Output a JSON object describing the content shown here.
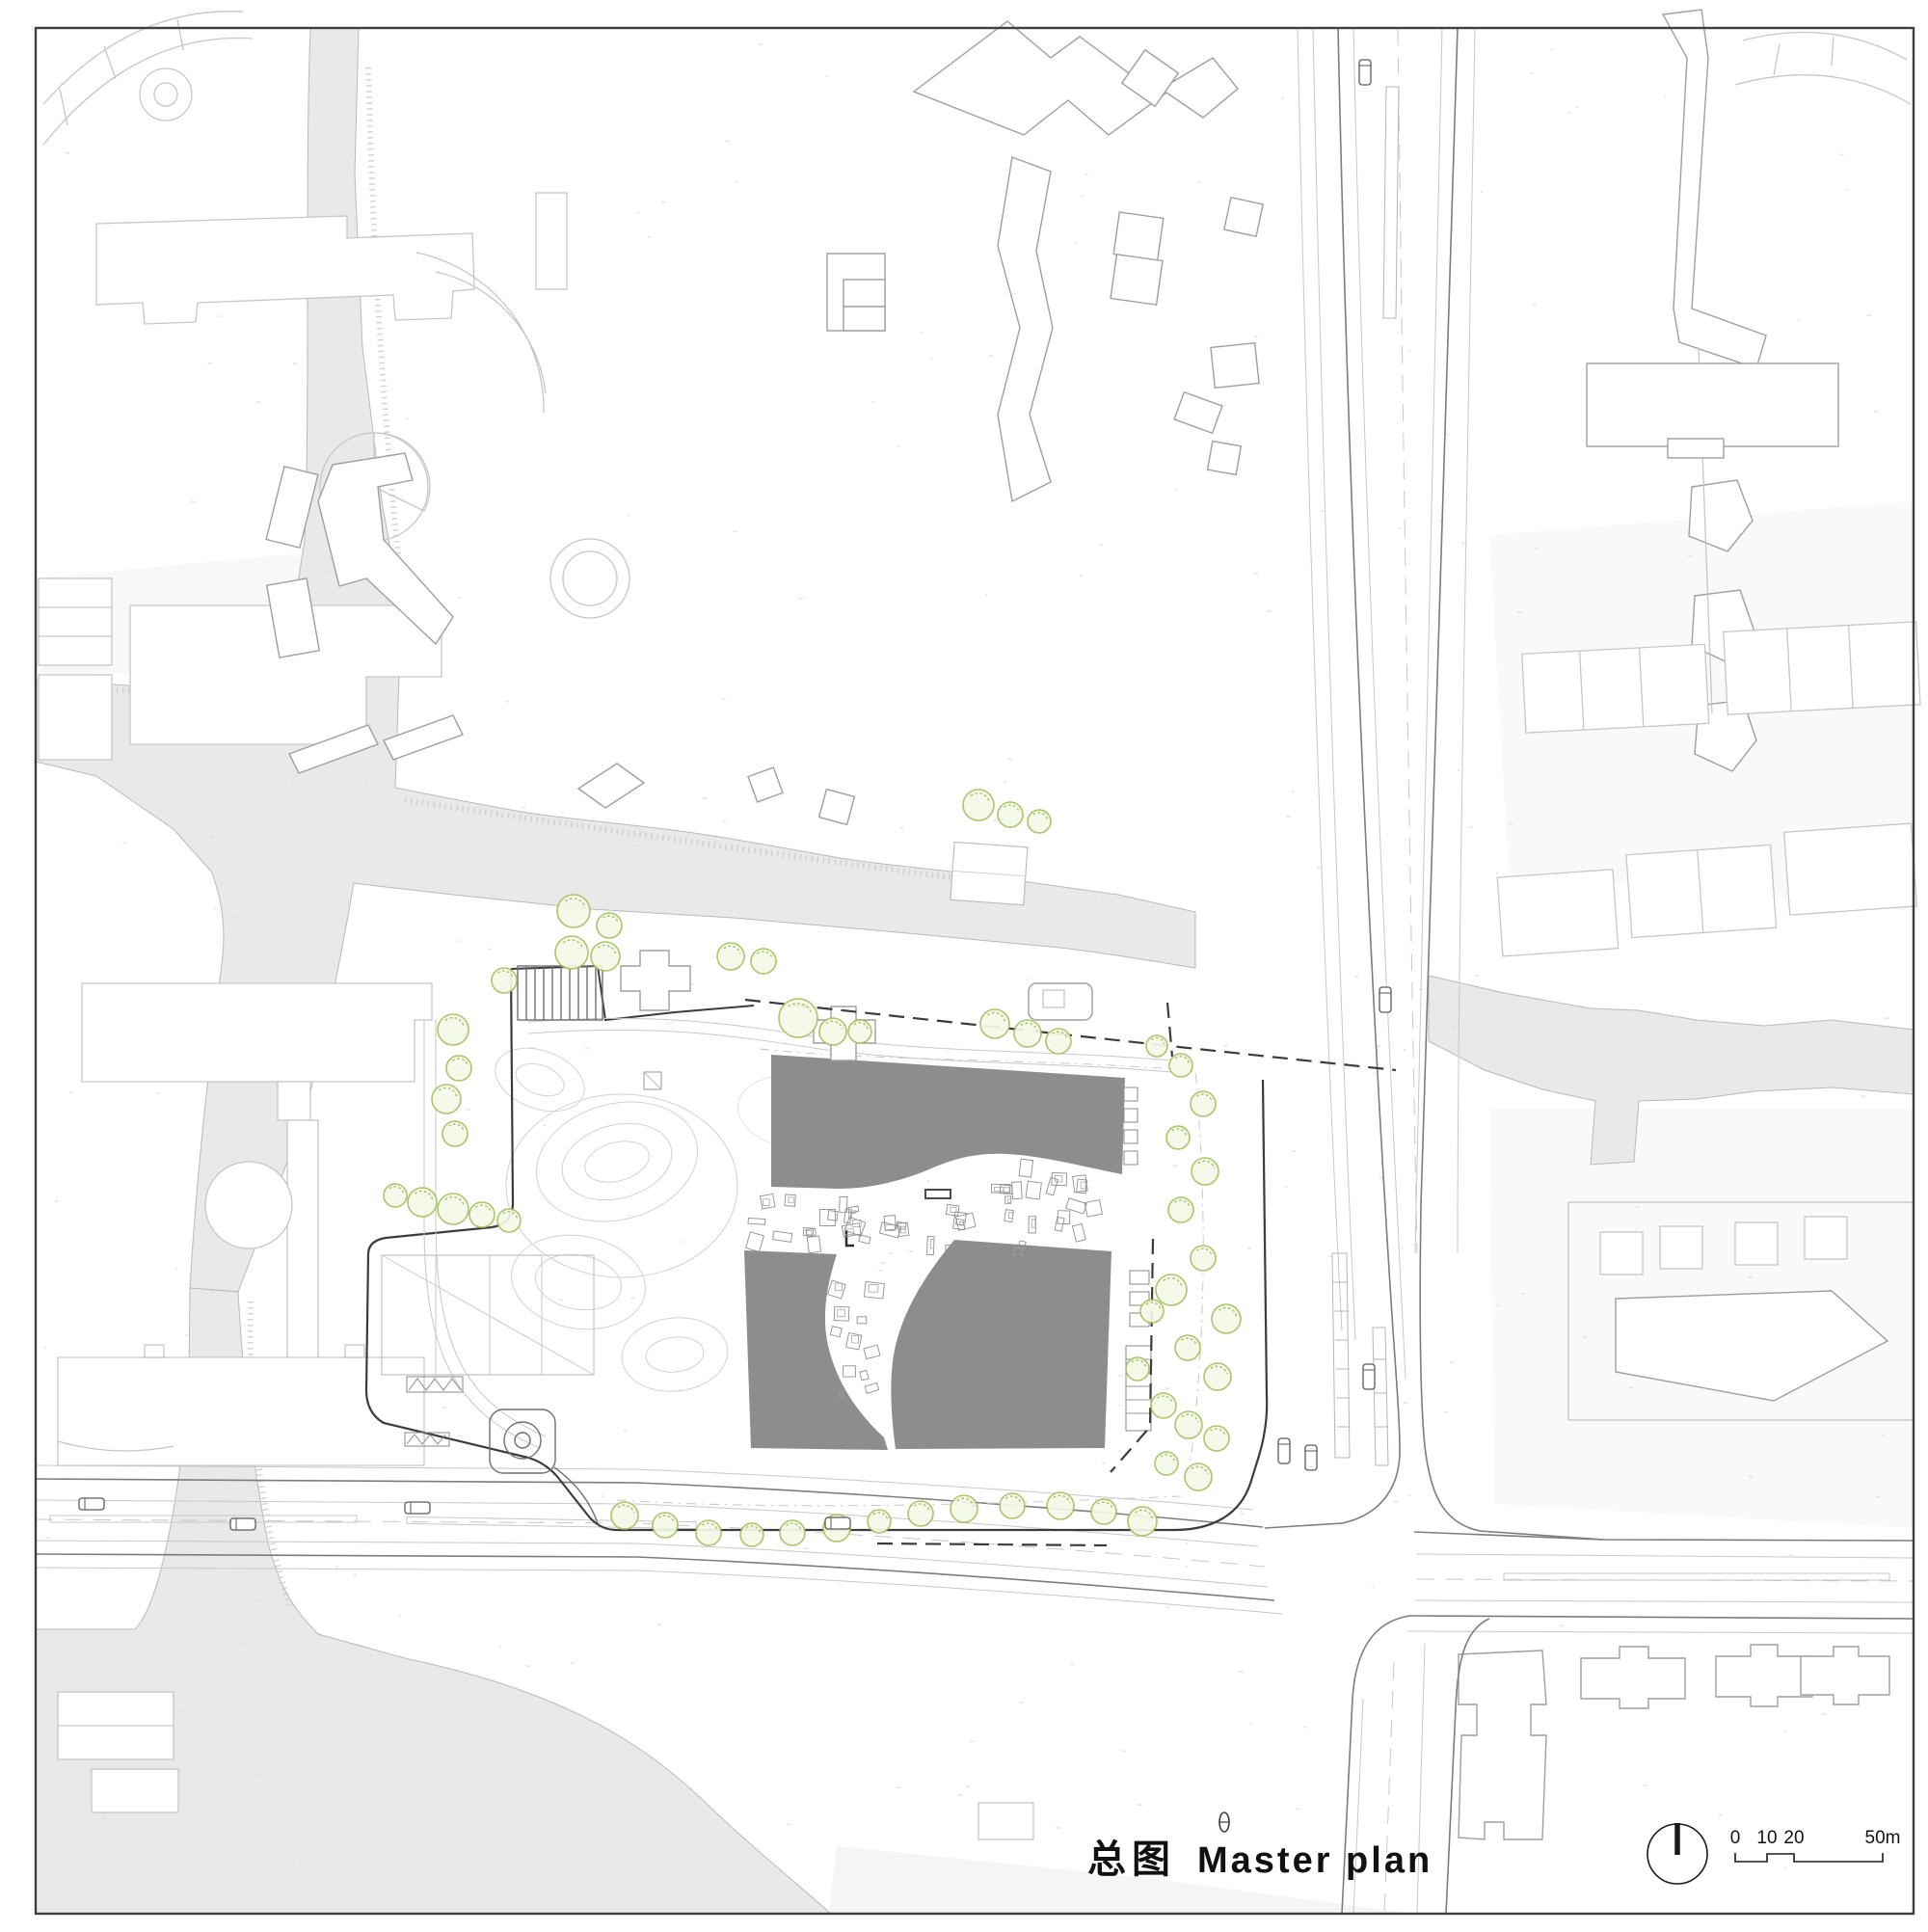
{
  "title": {
    "zh": "总图",
    "en": "Master plan"
  },
  "scale_bar": {
    "labels": [
      "0",
      "10",
      "20",
      "50m"
    ]
  },
  "icons": {
    "north_arrow": "circle-with-vertical-needle"
  },
  "colors": {
    "paper": "#ffffff",
    "water": "#e9e9e8",
    "water_outline": "#b9b9b7",
    "building_mass": "#8d8d8b",
    "context_line": "#c6c6c6",
    "dark_line": "#3c3c3c",
    "tree_stroke": "#a5bf5e",
    "tree_fill": "#f5f9e8",
    "frame": "#3f3f3f"
  }
}
